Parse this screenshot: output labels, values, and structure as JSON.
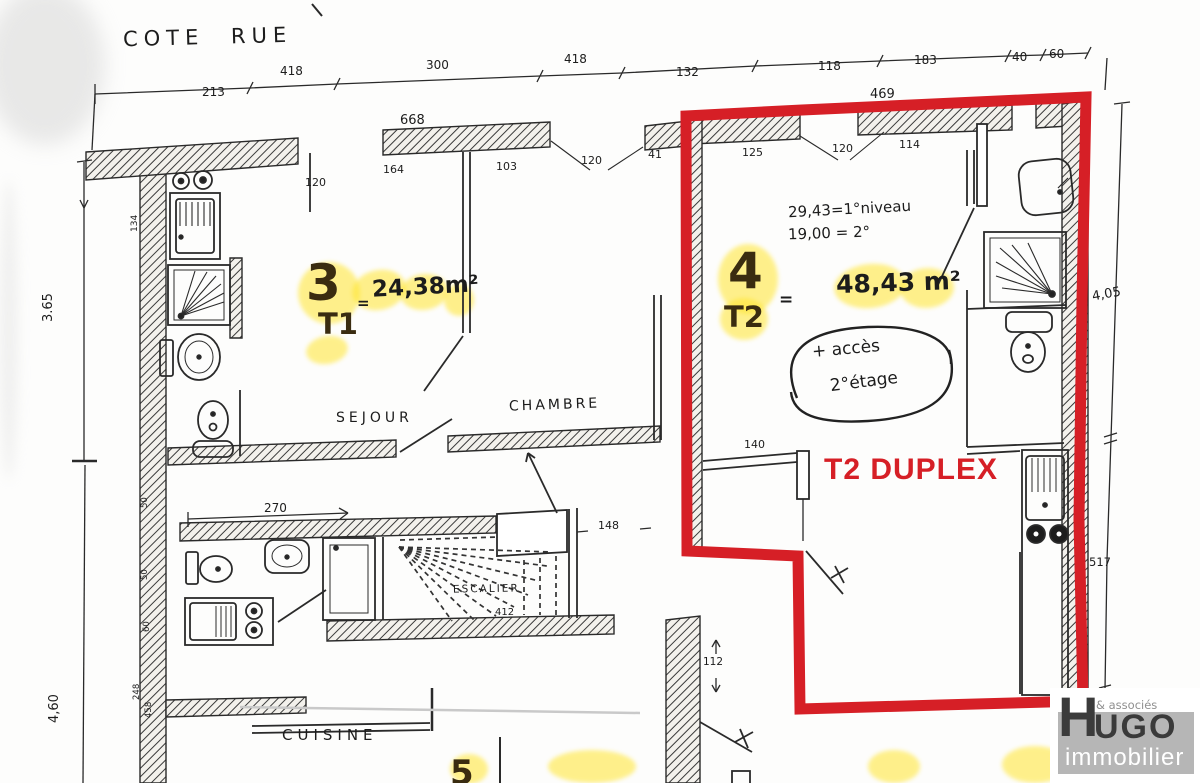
{
  "street_label": "COTE RUE",
  "dims": {
    "top": {
      "a": "213",
      "b": "418",
      "c": "300",
      "d": "418",
      "e": "132",
      "f": "118",
      "g": "183",
      "h": "40",
      "i": "60"
    },
    "walls": {
      "w668": "668",
      "w469": "469"
    },
    "row2": {
      "a": "120",
      "b": "164",
      "c": "103",
      "d": "120",
      "e": "41",
      "f": "125",
      "g": "120",
      "h": "114"
    },
    "inner": {
      "desk": "140",
      "corridor": "270",
      "hall": "148",
      "stairs": "412",
      "door": "112"
    },
    "left": {
      "total_top": "3.65",
      "total_bottom": "4,60",
      "seg134": "134",
      "seg50a": "50",
      "seg50b": "50",
      "seg60": "60",
      "seg248": "248",
      "seg458": "458"
    },
    "right": {
      "upper": "4,05",
      "lower": "517"
    }
  },
  "apt3": {
    "number": "3",
    "equals": "=",
    "area": "24,38m²",
    "type": "T1"
  },
  "apt4": {
    "number": "4",
    "equals": "=",
    "area": "48,43 m²",
    "type": "T2",
    "level1": "29,43=1°niveau",
    "level2": "19,00 = 2°",
    "access1": "+ accès",
    "access2": "2°étage",
    "duplex": "T2 DUPLEX"
  },
  "rooms": {
    "sejour": "SEJOUR",
    "chambre": "CHAMBRE",
    "escalier": "ESCALIER",
    "cuisine": "CUISINE"
  },
  "partials": {
    "room5": "5"
  },
  "logo": {
    "assoc": "& associés",
    "h": "H",
    "ugo": "UGO",
    "sub": "immobilier"
  },
  "colors": {
    "outline_red": "#d61f26",
    "highlight_yellow": "#ffe52e",
    "ink": "#1c1c1c",
    "logo_gray": "#b6b6b6",
    "logo_dark": "#3b3b3b"
  }
}
